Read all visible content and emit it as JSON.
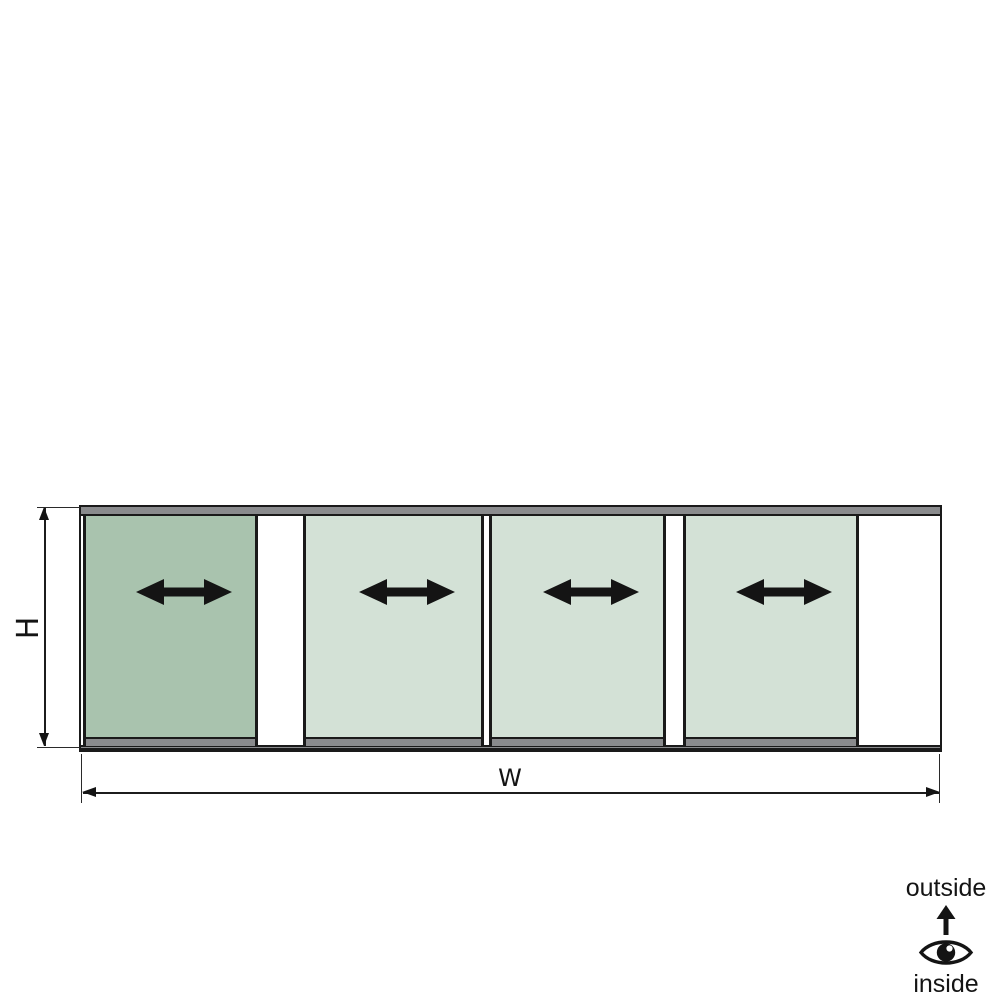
{
  "diagram": {
    "title": "sliding glass panel system - elevation drawing",
    "dimensions": {
      "height_label": "H",
      "width_label": "W"
    },
    "orientation_legend": {
      "top_label": "outside",
      "bottom_label": "inside",
      "icons": [
        "arrow-up-icon",
        "eye-icon"
      ]
    },
    "panels": [
      {
        "index": 1,
        "state": "active",
        "slide_direction": "horizontal-both"
      },
      {
        "index": 2,
        "state": "passive",
        "slide_direction": "horizontal-both"
      },
      {
        "index": 3,
        "state": "passive",
        "slide_direction": "horizontal-both"
      },
      {
        "index": 4,
        "state": "passive",
        "slide_direction": "horizontal-both"
      }
    ]
  },
  "colors": {
    "active_panel": "#a9c3ae",
    "passive_panel": "#d3e1d6",
    "rail_gray": "#8a8b8d",
    "frame_line": "#1a1a1a",
    "background": "#ffffff"
  }
}
